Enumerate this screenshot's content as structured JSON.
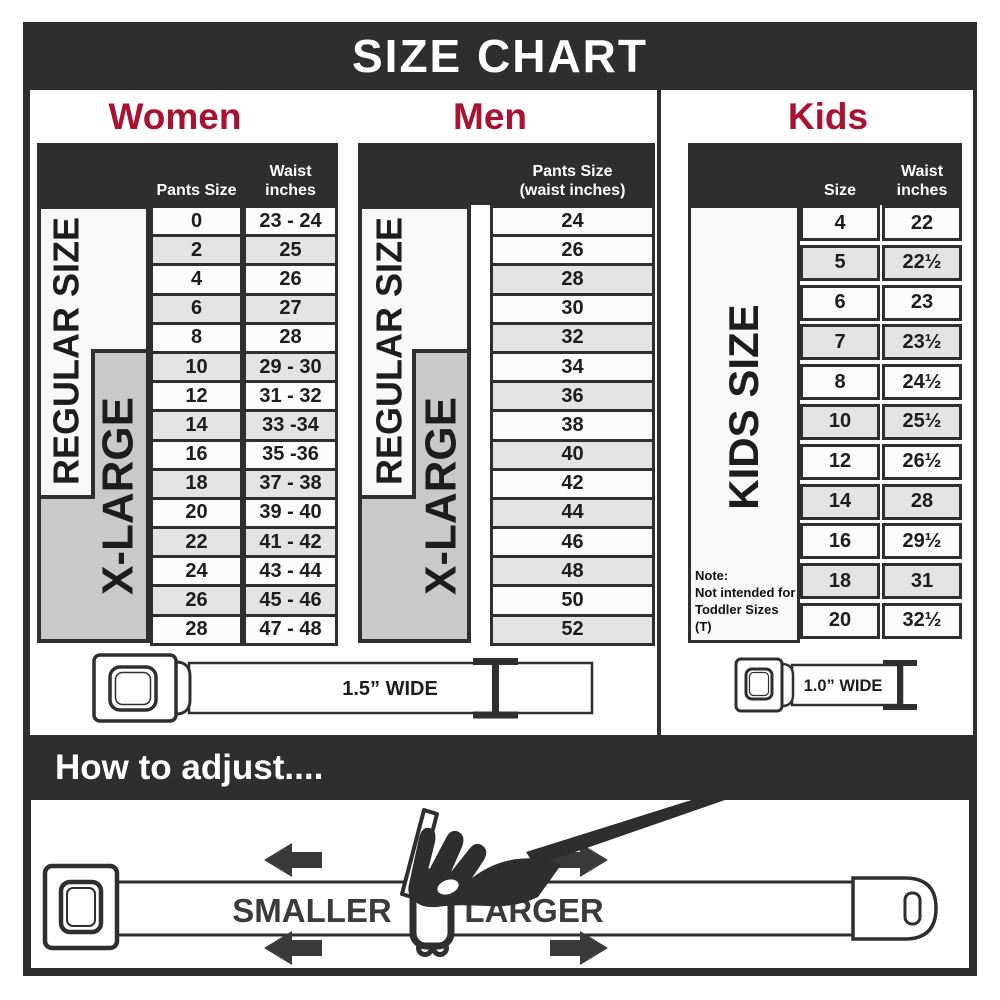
{
  "title": "SIZE CHART",
  "colors": {
    "dark": "#2d2e2d",
    "accent_red": "#a91230",
    "band_gray": "#c9c9c9",
    "band_white": "#f8f8f8",
    "row_gray": "#e3e3e3",
    "row_white": "#fbfbfb"
  },
  "sections": {
    "women": {
      "title": "Women",
      "col_size": "Pants Size",
      "col_waist_line1": "Waist",
      "col_waist_line2": "inches",
      "regular_label": "REGULAR SIZE",
      "xlarge_label": "X-LARGE"
    },
    "men": {
      "title": "Men",
      "col_line1": "Pants Size",
      "col_line2": "(waist inches)",
      "regular_label": "REGULAR SIZE",
      "xlarge_label": "X-LARGE"
    },
    "kids": {
      "title": "Kids",
      "col_size": "Size",
      "col_waist_line1": "Waist",
      "col_waist_line2": "inches",
      "band_label": "KIDS SIZE",
      "note_line1": "Note:",
      "note_line2": "Not intended for",
      "note_line3": "Toddler Sizes (T)"
    }
  },
  "belts": {
    "adult_label": "1.5” WIDE",
    "kids_label": "1.0” WIDE"
  },
  "adjust": {
    "title": "How to adjust....",
    "smaller_label": "SMALLER",
    "larger_label": "LARGER"
  },
  "chart_data": [
    {
      "type": "table",
      "title": "Women",
      "columns": [
        "Pants Size",
        "Waist inches"
      ],
      "rows": [
        [
          "0",
          "23 - 24"
        ],
        [
          "2",
          "25"
        ],
        [
          "4",
          "26"
        ],
        [
          "6",
          "27"
        ],
        [
          "8",
          "28"
        ],
        [
          "10",
          "29 - 30"
        ],
        [
          "12",
          "31 - 32"
        ],
        [
          "14",
          "33 -34"
        ],
        [
          "16",
          "35 -36"
        ],
        [
          "18",
          "37 - 38"
        ],
        [
          "20",
          "39 - 40"
        ],
        [
          "22",
          "41 - 42"
        ],
        [
          "24",
          "43 - 44"
        ],
        [
          "26",
          "45 - 46"
        ],
        [
          "28",
          "47 - 48"
        ]
      ],
      "row_groups": [
        {
          "label": "REGULAR SIZE",
          "covers_sizes": "0-18"
        },
        {
          "label": "X-LARGE",
          "covers_sizes": "10-28"
        }
      ],
      "belt_width": "1.5” WIDE"
    },
    {
      "type": "table",
      "title": "Men",
      "columns": [
        "Pants Size (waist inches)"
      ],
      "rows": [
        [
          "24"
        ],
        [
          "26"
        ],
        [
          "28"
        ],
        [
          "30"
        ],
        [
          "32"
        ],
        [
          "34"
        ],
        [
          "36"
        ],
        [
          "38"
        ],
        [
          "40"
        ],
        [
          "42"
        ],
        [
          "44"
        ],
        [
          "46"
        ],
        [
          "48"
        ],
        [
          "50"
        ],
        [
          "52"
        ]
      ],
      "row_groups": [
        {
          "label": "REGULAR SIZE",
          "covers_sizes": "24-42"
        },
        {
          "label": "X-LARGE",
          "covers_sizes": "34-52"
        }
      ],
      "belt_width": "1.5” WIDE"
    },
    {
      "type": "table",
      "title": "Kids",
      "columns": [
        "Size",
        "Waist inches"
      ],
      "rows": [
        [
          "4",
          "22"
        ],
        [
          "5",
          "22½"
        ],
        [
          "6",
          "23"
        ],
        [
          "7",
          "23½"
        ],
        [
          "8",
          "24½"
        ],
        [
          "10",
          "25½"
        ],
        [
          "12",
          "26½"
        ],
        [
          "14",
          "28"
        ],
        [
          "16",
          "29½"
        ],
        [
          "18",
          "31"
        ],
        [
          "20",
          "32½"
        ]
      ],
      "row_groups": [
        {
          "label": "KIDS SIZE",
          "covers_sizes": "4-20"
        }
      ],
      "note": "Note: Not intended for Toddler Sizes (T)",
      "belt_width": "1.0” WIDE"
    }
  ]
}
